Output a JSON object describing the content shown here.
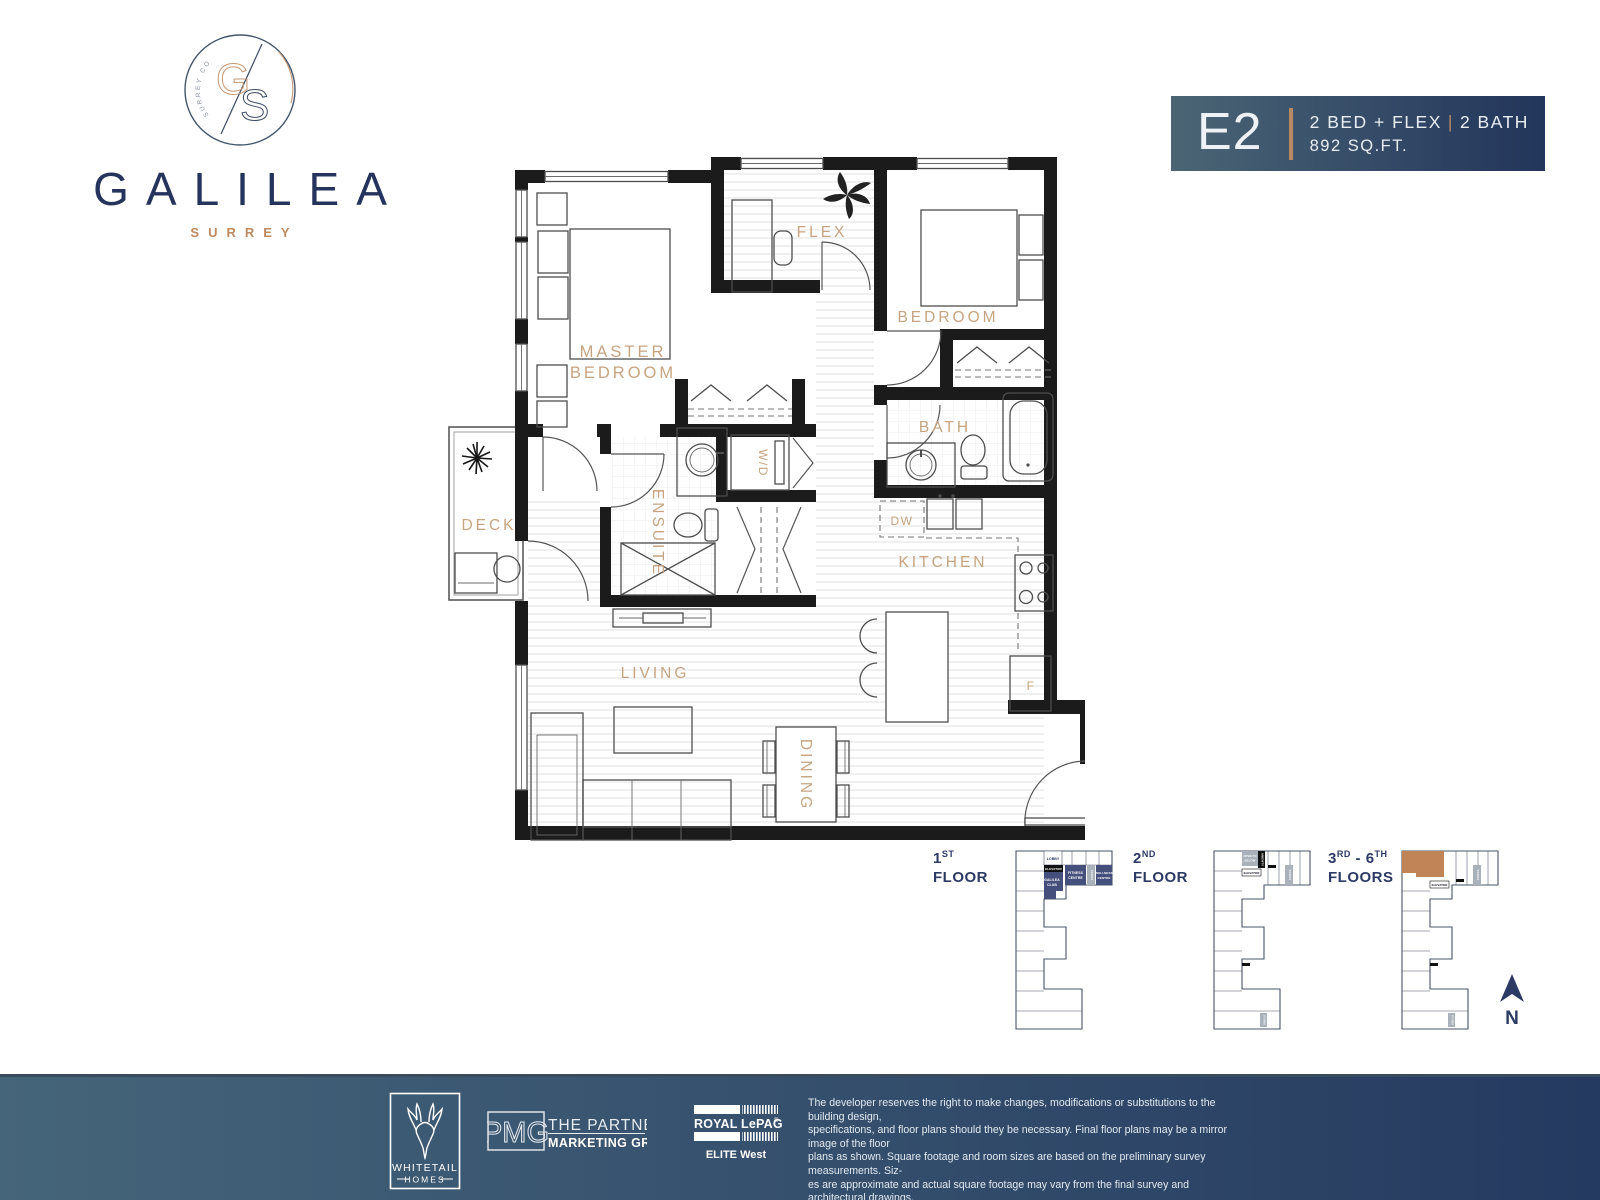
{
  "brand": {
    "name": "GALILEA",
    "city": "SURREY",
    "monogram_g": "G",
    "monogram_s": "S",
    "circle_text": "SURREY CONDOS"
  },
  "unit": {
    "code": "E2",
    "beds": "2 BED + FLEX",
    "sep": "|",
    "baths": "2 BATH",
    "area": "892 SQ.FT."
  },
  "plan": {
    "rooms": {
      "master1": "MASTER",
      "master2": "BEDROOM",
      "flex": "FLEX",
      "bedroom": "BEDROOM",
      "bath": "BATH",
      "ensuite": "ENSUITE",
      "wd": "W/D",
      "deck": "DECK",
      "dw": "DW",
      "kitchen": "KITCHEN",
      "fridge": "F",
      "living": "LIVING",
      "dining": "DINING"
    }
  },
  "keyplans": {
    "f1": {
      "num": "1",
      "sup": "ST",
      "word": "FLOOR"
    },
    "f2": {
      "num": "2",
      "sup": "ND",
      "word": "FLOOR"
    },
    "f3": {
      "num": "3",
      "sup": "RD",
      "dash": " - ",
      "num2": "6",
      "sup2": "TH",
      "word": "FLOORS"
    },
    "labels": {
      "lobby": "LOBBY",
      "elevator": "ELEVATOR",
      "fitness1": "FITNESS",
      "fitness2": "CENTRE",
      "stairs": "STAIRS",
      "wellness1": "WELLNESS",
      "wellness2": "CENTRE",
      "club1": "GALILEA",
      "club2": "CLUB",
      "open1": "OPEN TO",
      "open2": "BELOW",
      "amenity": "AMENITY"
    },
    "north": "N"
  },
  "footer": {
    "whitetail": {
      "name": "WHITETAIL",
      "sub": "HOMES"
    },
    "pmg": {
      "abbr": "PMG",
      "line1": "THE PARTNERS",
      "line2": "MARKETING GROUP"
    },
    "royal": {
      "name": "ROYAL LePAGE",
      "reg": "®",
      "sub": "ELITE West"
    },
    "disclaimer": {
      "l1": "The developer reserves the right to make changes, modifications or substitutions to the building design,",
      "l2": "specifications, and floor plans should they be necessary. Final floor plans may be a mirror image of the floor",
      "l3": "plans as shown. Square footage and room sizes are based on the preliminary survey measurements. Siz-",
      "l4": "es are approximate and actual square footage may vary from the final survey and architectural drawings."
    }
  },
  "colors": {
    "navy": "#26335d",
    "copper": "#bf8a5f",
    "label_copper": "#c7a481",
    "banner_start": "#4b6575",
    "banner_end": "#22355b",
    "footer_start": "#45657a",
    "footer_end": "#253a60",
    "keyplan_navy": "#454f7c",
    "keyplan_gray": "#a9b1bb",
    "unit_highlight": "#c18457",
    "wall_black": "#1b1b1b"
  }
}
